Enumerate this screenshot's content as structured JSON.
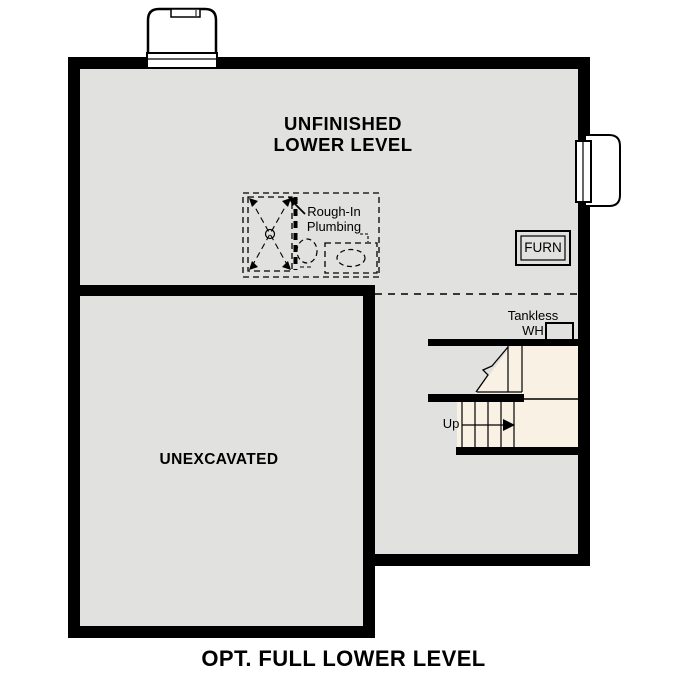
{
  "labels": {
    "unfinished": {
      "line1": "UNFINISHED",
      "line2": "LOWER LEVEL"
    },
    "rough_in": {
      "line1": "Rough-In",
      "line2": "Plumbing"
    },
    "furnace": "FURN",
    "tankless": {
      "line1": "Tankless",
      "line2": "WH"
    },
    "stairs": {
      "up": "Up"
    },
    "unexcavated": "UNEXCAVATED"
  },
  "title": "OPT. FULL LOWER LEVEL",
  "colors": {
    "wall": "#000000",
    "floor_gray": "#e1e1df",
    "stairwell_cream": "#f8f1e4",
    "background": "#ffffff",
    "text": "#000000"
  }
}
